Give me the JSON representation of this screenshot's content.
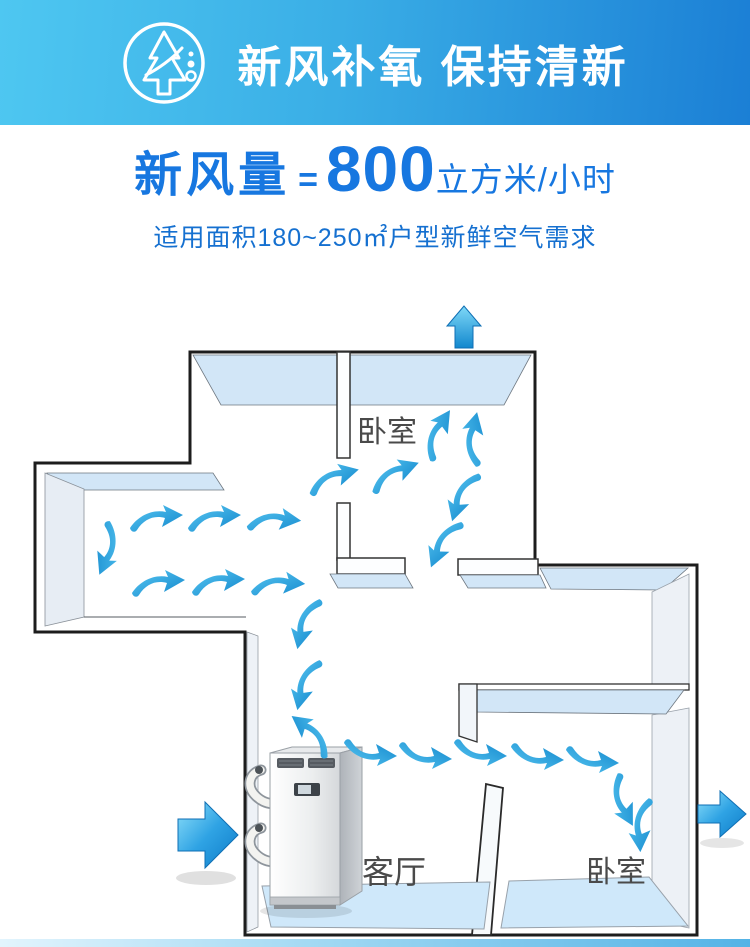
{
  "header": {
    "title": "新风补氧 保持清新"
  },
  "headline": {
    "label": "新风量",
    "equals": "=",
    "value": "800",
    "unit": "立方米/小时"
  },
  "subtitle": {
    "text": "适用面积180~250㎡户型新鲜空气需求"
  },
  "floorplan": {
    "rooms": {
      "bedroom_top": "卧室",
      "living": "客厅",
      "bedroom_bottom": "卧室"
    },
    "airflow_color": "#2ba6e4",
    "wall_face_blue": "#d2e6f7",
    "floor_blue": "#cfe8fa",
    "big_arrows": [
      "exhaust-up",
      "intake-left",
      "outlet-right"
    ]
  },
  "colors": {
    "banner_left": "#4ec7f1",
    "banner_right": "#1b7fd5",
    "headline_blue": "#1777e0",
    "subtitle_blue": "#1570d0",
    "footer_bar_right": "#54b3e6"
  }
}
